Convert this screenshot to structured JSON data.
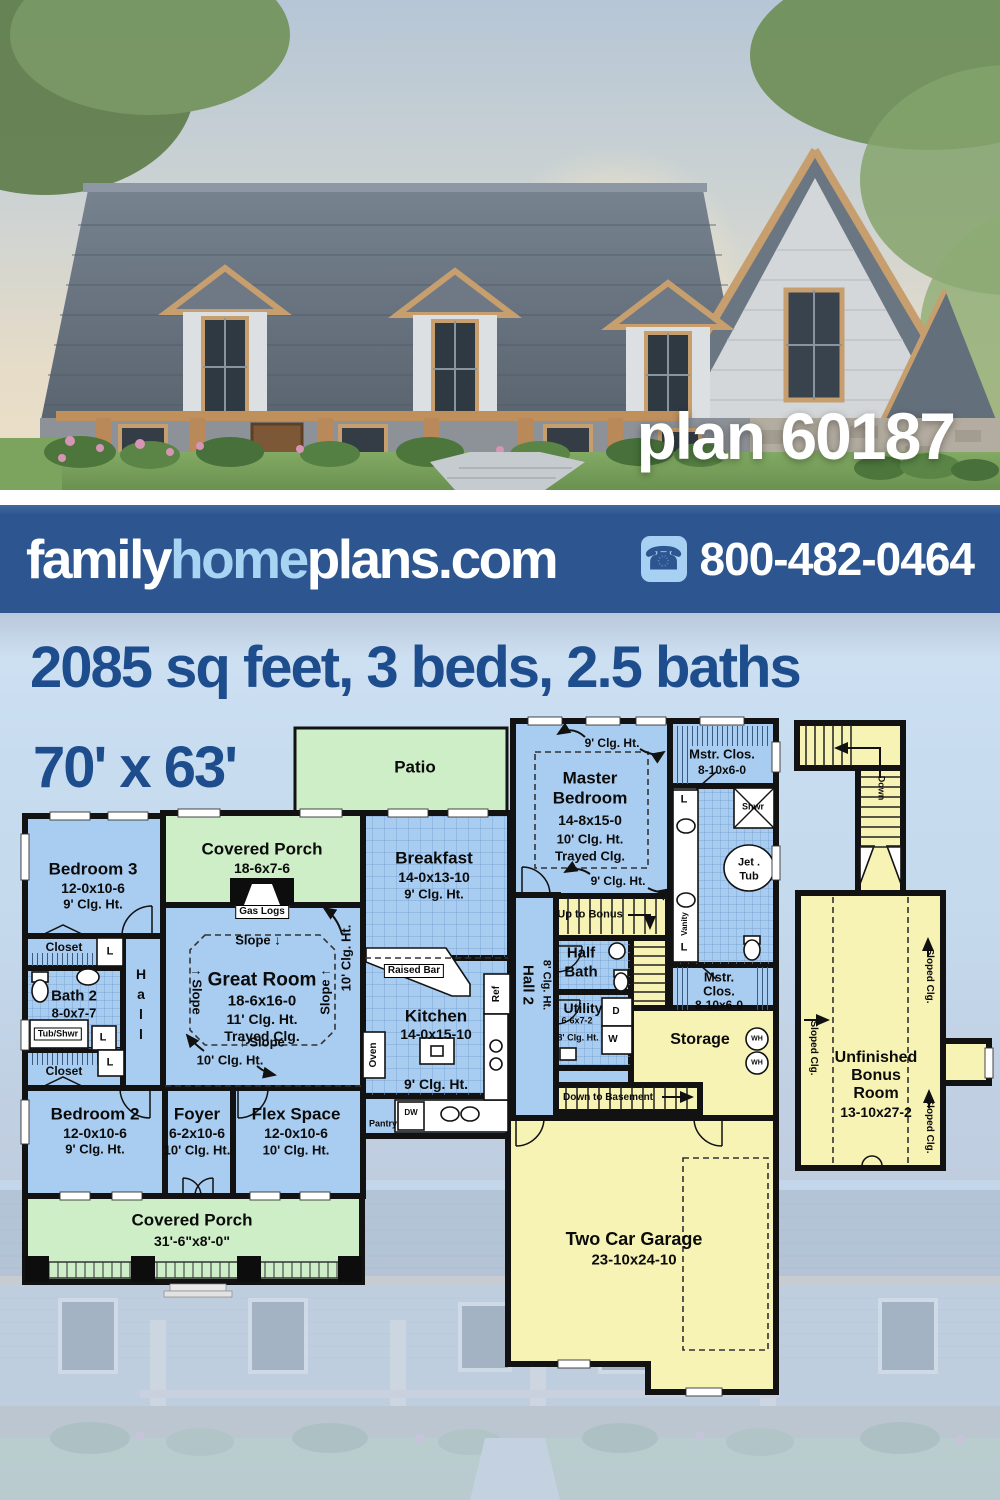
{
  "hero": {
    "plan_label": "plan 60187"
  },
  "banner": {
    "logo_family": "family",
    "logo_home": "home",
    "logo_plans": "plans.com",
    "phone_icon": "phone-icon",
    "phone": "800-482-0464"
  },
  "headline": {
    "line1": "2085 sq feet, 3 beds, 2.5 baths",
    "line2": "70' x 63'"
  },
  "colors": {
    "banner_blue": "#2d5690",
    "logo_light_blue": "#a8d4f4",
    "headline_blue": "#1d4d8d",
    "room_blue": "#a9cdf1",
    "room_green": "#cdeec6",
    "room_yellow": "#f7f3b5",
    "wall_black": "#121212",
    "page_light_blue": "#c8dcf0"
  },
  "floorplan": {
    "labels": [
      {
        "t": "Patio",
        "x": 415,
        "y": 767,
        "fs": 17
      },
      {
        "t": "Covered Porch",
        "x": 262,
        "y": 849,
        "fs": 17
      },
      {
        "t": "18-6x7-6",
        "x": 262,
        "y": 868,
        "fs": 14
      },
      {
        "t": "Gas Logs",
        "x": 262,
        "y": 912,
        "fs": 10,
        "cls": "box"
      },
      {
        "t": "Bedroom 3",
        "x": 93,
        "y": 869,
        "fs": 17
      },
      {
        "t": "12-0x10-6",
        "x": 93,
        "y": 888,
        "fs": 14
      },
      {
        "t": "9' Clg. Ht.",
        "x": 93,
        "y": 904,
        "fs": 13
      },
      {
        "t": "Closet",
        "x": 64,
        "y": 947,
        "fs": 12
      },
      {
        "t": "L",
        "x": 110,
        "y": 952,
        "fs": 11
      },
      {
        "t": "Hall",
        "x": 141,
        "y": 1006,
        "fs": 14,
        "cls": "vup"
      },
      {
        "t": "Bath 2",
        "x": 74,
        "y": 996,
        "fs": 15
      },
      {
        "t": "8-0x7-7",
        "x": 74,
        "y": 1013,
        "fs": 13
      },
      {
        "t": "Tub/Shwr",
        "x": 58,
        "y": 1034,
        "fs": 9,
        "cls": "box"
      },
      {
        "t": "L",
        "x": 103,
        "y": 1038,
        "fs": 11
      },
      {
        "t": "Closet",
        "x": 64,
        "y": 1071,
        "fs": 12
      },
      {
        "t": "L",
        "x": 110,
        "y": 1063,
        "fs": 11
      },
      {
        "t": "Great Room",
        "x": 262,
        "y": 980,
        "fs": 19
      },
      {
        "t": "18-6x16-0",
        "x": 262,
        "y": 1001,
        "fs": 15
      },
      {
        "t": "11' Clg. Ht.",
        "x": 262,
        "y": 1019,
        "fs": 14
      },
      {
        "t": "Trayed Clg.",
        "x": 262,
        "y": 1036,
        "fs": 14
      },
      {
        "t": "Slope ↓",
        "x": 258,
        "y": 940,
        "fs": 13
      },
      {
        "t": "↑ Slope",
        "x": 262,
        "y": 1042,
        "fs": 13
      },
      {
        "t": "↑ Slope",
        "x": 197,
        "y": 992,
        "fs": 13,
        "rot": 90
      },
      {
        "t": "Slope ↑",
        "x": 325,
        "y": 992,
        "fs": 13,
        "rot": -90
      },
      {
        "t": "10' Clg. Ht.",
        "x": 230,
        "y": 1060,
        "fs": 13
      },
      {
        "t": "10' Clg. Ht.",
        "x": 346,
        "y": 958,
        "fs": 13,
        "rot": -90
      },
      {
        "t": "Breakfast",
        "x": 434,
        "y": 858,
        "fs": 17
      },
      {
        "t": "14-0x13-10",
        "x": 434,
        "y": 877,
        "fs": 14
      },
      {
        "t": "9' Clg. Ht.",
        "x": 434,
        "y": 894,
        "fs": 13
      },
      {
        "t": "Raised Bar",
        "x": 414,
        "y": 971,
        "fs": 10,
        "cls": "box"
      },
      {
        "t": "Kitchen",
        "x": 436,
        "y": 1016,
        "fs": 17
      },
      {
        "t": "14-0x15-10",
        "x": 436,
        "y": 1034,
        "fs": 14
      },
      {
        "t": "9' Clg. Ht.",
        "x": 436,
        "y": 1084,
        "fs": 14
      },
      {
        "t": "Oven",
        "x": 374,
        "y": 1055,
        "fs": 10,
        "rot": -90
      },
      {
        "t": "Ref",
        "x": 497,
        "y": 994,
        "fs": 10,
        "rot": -90
      },
      {
        "t": "Pantry",
        "x": 383,
        "y": 1124,
        "fs": 9
      },
      {
        "t": "DW",
        "x": 411,
        "y": 1113,
        "fs": 8
      },
      {
        "t": "Bedroom 2",
        "x": 95,
        "y": 1114,
        "fs": 17
      },
      {
        "t": "12-0x10-6",
        "x": 95,
        "y": 1133,
        "fs": 14
      },
      {
        "t": "9' Clg. Ht.",
        "x": 95,
        "y": 1149,
        "fs": 13
      },
      {
        "t": "Foyer",
        "x": 197,
        "y": 1114,
        "fs": 17
      },
      {
        "t": "6-2x10-6",
        "x": 197,
        "y": 1133,
        "fs": 14
      },
      {
        "t": "10' Clg. Ht.",
        "x": 197,
        "y": 1150,
        "fs": 13
      },
      {
        "t": "Flex Space",
        "x": 296,
        "y": 1114,
        "fs": 17
      },
      {
        "t": "12-0x10-6",
        "x": 296,
        "y": 1133,
        "fs": 14
      },
      {
        "t": "10' Clg. Ht.",
        "x": 296,
        "y": 1150,
        "fs": 13
      },
      {
        "t": "Covered Porch",
        "x": 192,
        "y": 1220,
        "fs": 17
      },
      {
        "t": "31'-6\"x8'-0\"",
        "x": 192,
        "y": 1241,
        "fs": 14
      },
      {
        "t": "Master",
        "x": 590,
        "y": 778,
        "fs": 17
      },
      {
        "t": "Bedroom",
        "x": 590,
        "y": 798,
        "fs": 17
      },
      {
        "t": "14-8x15-0",
        "x": 590,
        "y": 820,
        "fs": 14
      },
      {
        "t": "10' Clg. Ht.",
        "x": 590,
        "y": 839,
        "fs": 13
      },
      {
        "t": "Trayed Clg.",
        "x": 590,
        "y": 856,
        "fs": 13
      },
      {
        "t": "9' Clg. Ht.",
        "x": 612,
        "y": 743,
        "fs": 12
      },
      {
        "t": "9' Clg. Ht.",
        "x": 618,
        "y": 881,
        "fs": 12
      },
      {
        "t": "Hall 2",
        "x": 528,
        "y": 985,
        "fs": 15,
        "rot": 90
      },
      {
        "t": "8' Clg. Ht.",
        "x": 546,
        "y": 985,
        "fs": 11,
        "rot": 90
      },
      {
        "t": "Up to Bonus",
        "x": 590,
        "y": 915,
        "fs": 11
      },
      {
        "t": "Half",
        "x": 581,
        "y": 953,
        "fs": 15
      },
      {
        "t": "Bath",
        "x": 581,
        "y": 972,
        "fs": 15
      },
      {
        "t": "Utility",
        "x": 583,
        "y": 1008,
        "fs": 14
      },
      {
        "t": "6-6x7-2",
        "x": 577,
        "y": 1021,
        "fs": 9
      },
      {
        "t": "8' Clg. Ht.",
        "x": 578,
        "y": 1038,
        "fs": 9
      },
      {
        "t": "D",
        "x": 616,
        "y": 1012,
        "fs": 10
      },
      {
        "t": "W",
        "x": 613,
        "y": 1040,
        "fs": 10
      },
      {
        "t": "Storage",
        "x": 700,
        "y": 1040,
        "fs": 16
      },
      {
        "t": "WH",
        "x": 757,
        "y": 1039,
        "fs": 7
      },
      {
        "t": "WH",
        "x": 757,
        "y": 1063,
        "fs": 7
      },
      {
        "t": "Mstr. Clos.",
        "x": 722,
        "y": 754,
        "fs": 13
      },
      {
        "t": "8-10x6-0",
        "x": 722,
        "y": 770,
        "fs": 12
      },
      {
        "t": "L",
        "x": 684,
        "y": 800,
        "fs": 11
      },
      {
        "t": "Shwr",
        "x": 753,
        "y": 807,
        "fs": 9
      },
      {
        "t": "Jet .",
        "x": 749,
        "y": 863,
        "fs": 11
      },
      {
        "t": "Tub",
        "x": 749,
        "y": 877,
        "fs": 11
      },
      {
        "t": "Vanity",
        "x": 685,
        "y": 924,
        "fs": 8,
        "rot": -90
      },
      {
        "t": "L",
        "x": 684,
        "y": 948,
        "fs": 11
      },
      {
        "t": "Mstr.",
        "x": 719,
        "y": 977,
        "fs": 13
      },
      {
        "t": "Clos.",
        "x": 719,
        "y": 991,
        "fs": 13
      },
      {
        "t": "8-10x6-0",
        "x": 719,
        "y": 1005,
        "fs": 12
      },
      {
        "t": "Down to Basement",
        "x": 608,
        "y": 1098,
        "fs": 10
      },
      {
        "t": "Two Car Garage",
        "x": 634,
        "y": 1239,
        "fs": 18
      },
      {
        "t": "23-10x24-10",
        "x": 634,
        "y": 1260,
        "fs": 15
      },
      {
        "t": "Down",
        "x": 881,
        "y": 788,
        "fs": 9,
        "rot": 90
      },
      {
        "t": "Sloped Clg.",
        "x": 929,
        "y": 976,
        "fs": 10,
        "rot": 90
      },
      {
        "t": "Sloped Clg.",
        "x": 813,
        "y": 1048,
        "fs": 10,
        "rot": 90
      },
      {
        "t": "Sloped Clg.",
        "x": 929,
        "y": 1126,
        "fs": 10,
        "rot": 90
      },
      {
        "t": "Unfinished",
        "x": 876,
        "y": 1058,
        "fs": 16
      },
      {
        "t": "Bonus",
        "x": 876,
        "y": 1076,
        "fs": 16
      },
      {
        "t": "Room",
        "x": 876,
        "y": 1094,
        "fs": 16
      },
      {
        "t": "13-10x27-2",
        "x": 876,
        "y": 1112,
        "fs": 14
      }
    ]
  }
}
